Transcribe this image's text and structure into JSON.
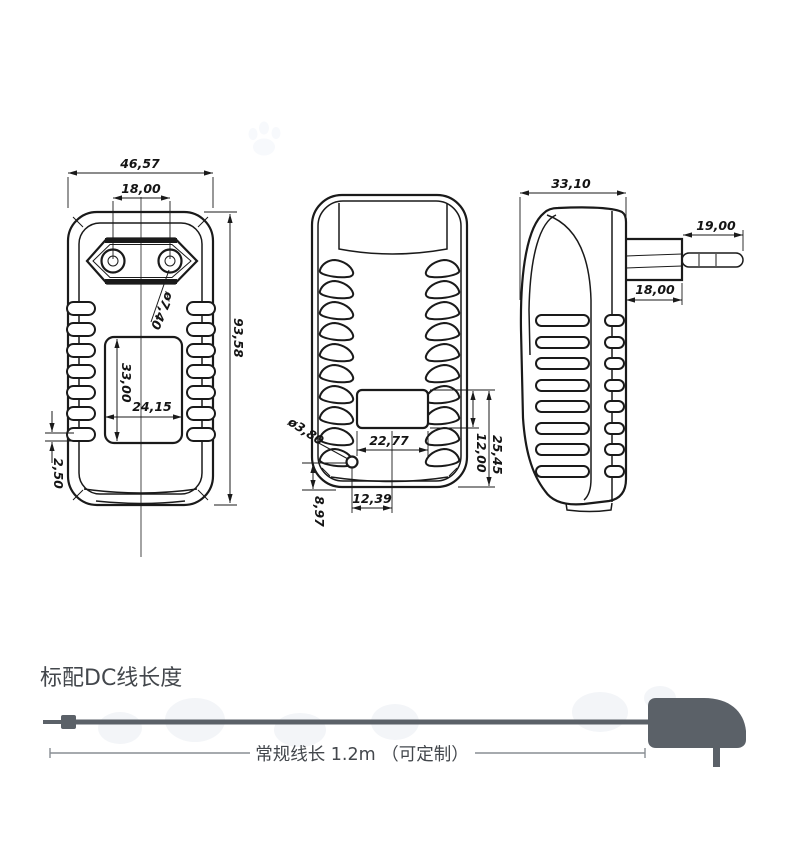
{
  "title_section": {
    "heading": "标配DC线长度"
  },
  "cable_diagram": {
    "length_label": "常规线长 1.2m （可定制）",
    "cable_color": "#5b6168",
    "text_color": "#43474c"
  },
  "views": {
    "front": {
      "overall_width": "46,57",
      "pin_spacing": "18,00",
      "pin_hole_diameter": "ø7,40",
      "overall_height": "93,58",
      "label_area_height": "33,00",
      "label_area_width": "24,15",
      "vent_gap": "2,50"
    },
    "back": {
      "cord_hole_diameter": "ø3,80",
      "label_area_width": "22,77",
      "cord_hole_offset_x": "12,39",
      "cord_hole_offset_y": "8,97",
      "lower_section_height": "25,45",
      "label_area_height": "12,00"
    },
    "side": {
      "body_depth": "33,10",
      "pin_length": "19,00",
      "plug_base_depth": "18,00"
    }
  }
}
